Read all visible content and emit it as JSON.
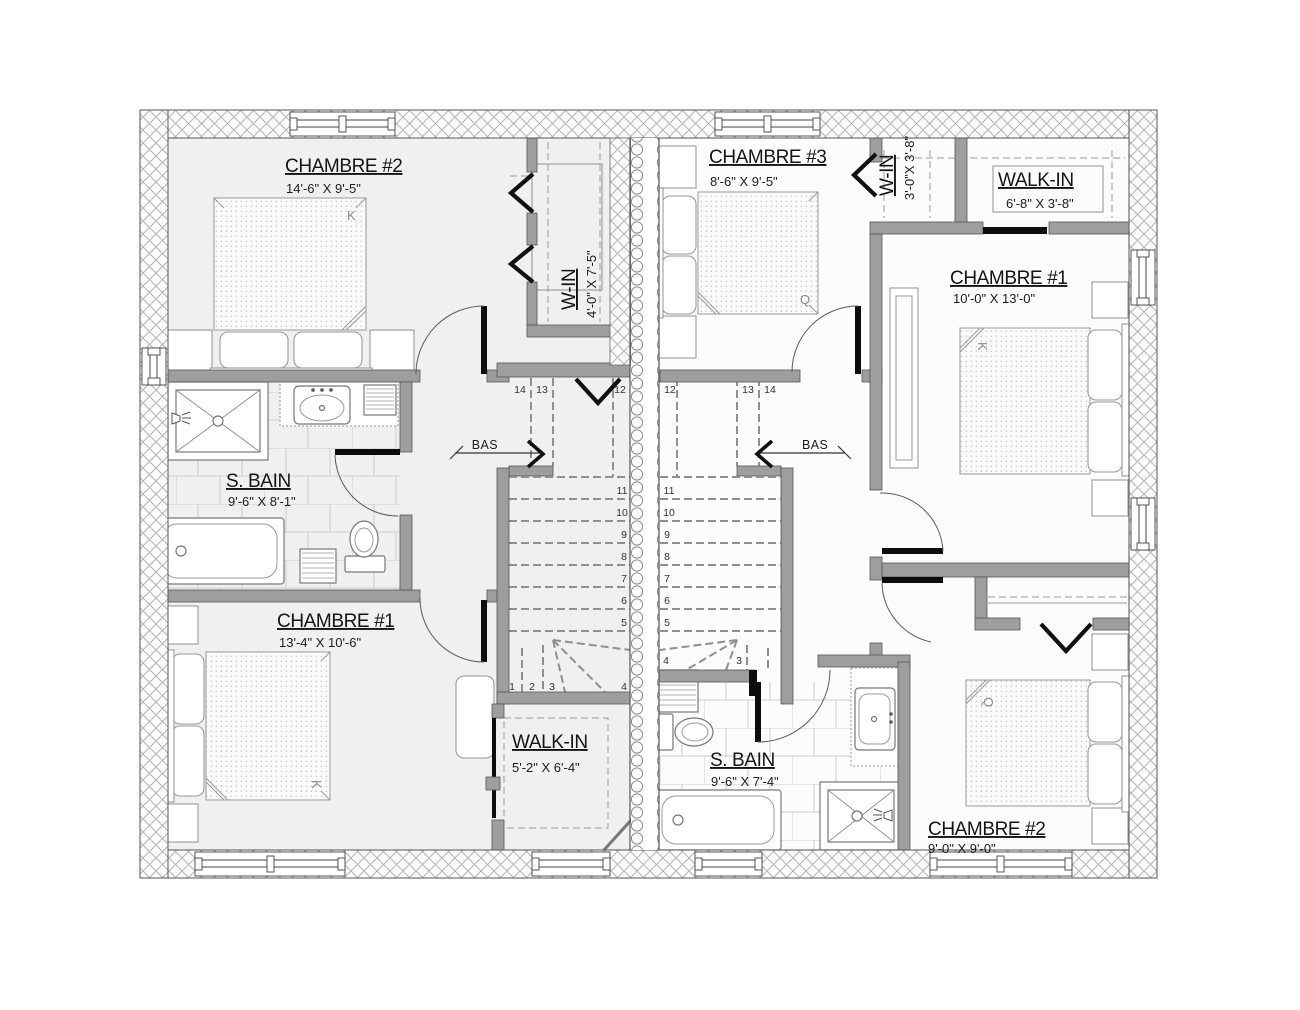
{
  "rooms": [
    {
      "id": "chambre2-left",
      "label": "CHAMBRE #2",
      "dims": "14'-6\" X 9'-5\""
    },
    {
      "id": "win-left",
      "label": "W-IN",
      "dims": "4'-0\" X 7'-5\""
    },
    {
      "id": "chambre3-right",
      "label": "CHAMBRE #3",
      "dims": "8'-6\" X 9'-5\""
    },
    {
      "id": "win-right",
      "label": "W-IN",
      "dims": "3'-0\"X 3'-8\""
    },
    {
      "id": "walkin-right-top",
      "label": "WALK-IN",
      "dims": "6'-8\" X 3'-8\""
    },
    {
      "id": "chambre1-right",
      "label": "CHAMBRE #1",
      "dims": "10'-0\" X 13'-0\""
    },
    {
      "id": "sbain-left",
      "label": "S. BAIN",
      "dims": "9'-6\" X 8'-1\""
    },
    {
      "id": "chambre1-left",
      "label": "CHAMBRE #1",
      "dims": "13'-4\" X 10'-6\""
    },
    {
      "id": "walkin-left",
      "label": "WALK-IN",
      "dims": "5'-2\" X 6'-4\""
    },
    {
      "id": "sbain-right",
      "label": "S. BAIN",
      "dims": "9'-6\" X 7'-4\""
    },
    {
      "id": "chambre2-right",
      "label": "CHAMBRE #2",
      "dims": "9'-0\" X 9'-0\""
    }
  ],
  "stairs": {
    "bas_label": "BAS",
    "left_treads": [
      "1",
      "2",
      "3",
      "4",
      "5",
      "6",
      "7",
      "8",
      "9",
      "10",
      "11",
      "12",
      "13",
      "14"
    ],
    "right_treads": [
      "1",
      "2",
      "3",
      "4",
      "5",
      "6",
      "7",
      "8",
      "9",
      "10",
      "11",
      "12",
      "13",
      "14"
    ]
  },
  "beds": {
    "king": "K",
    "queen": "Q"
  }
}
